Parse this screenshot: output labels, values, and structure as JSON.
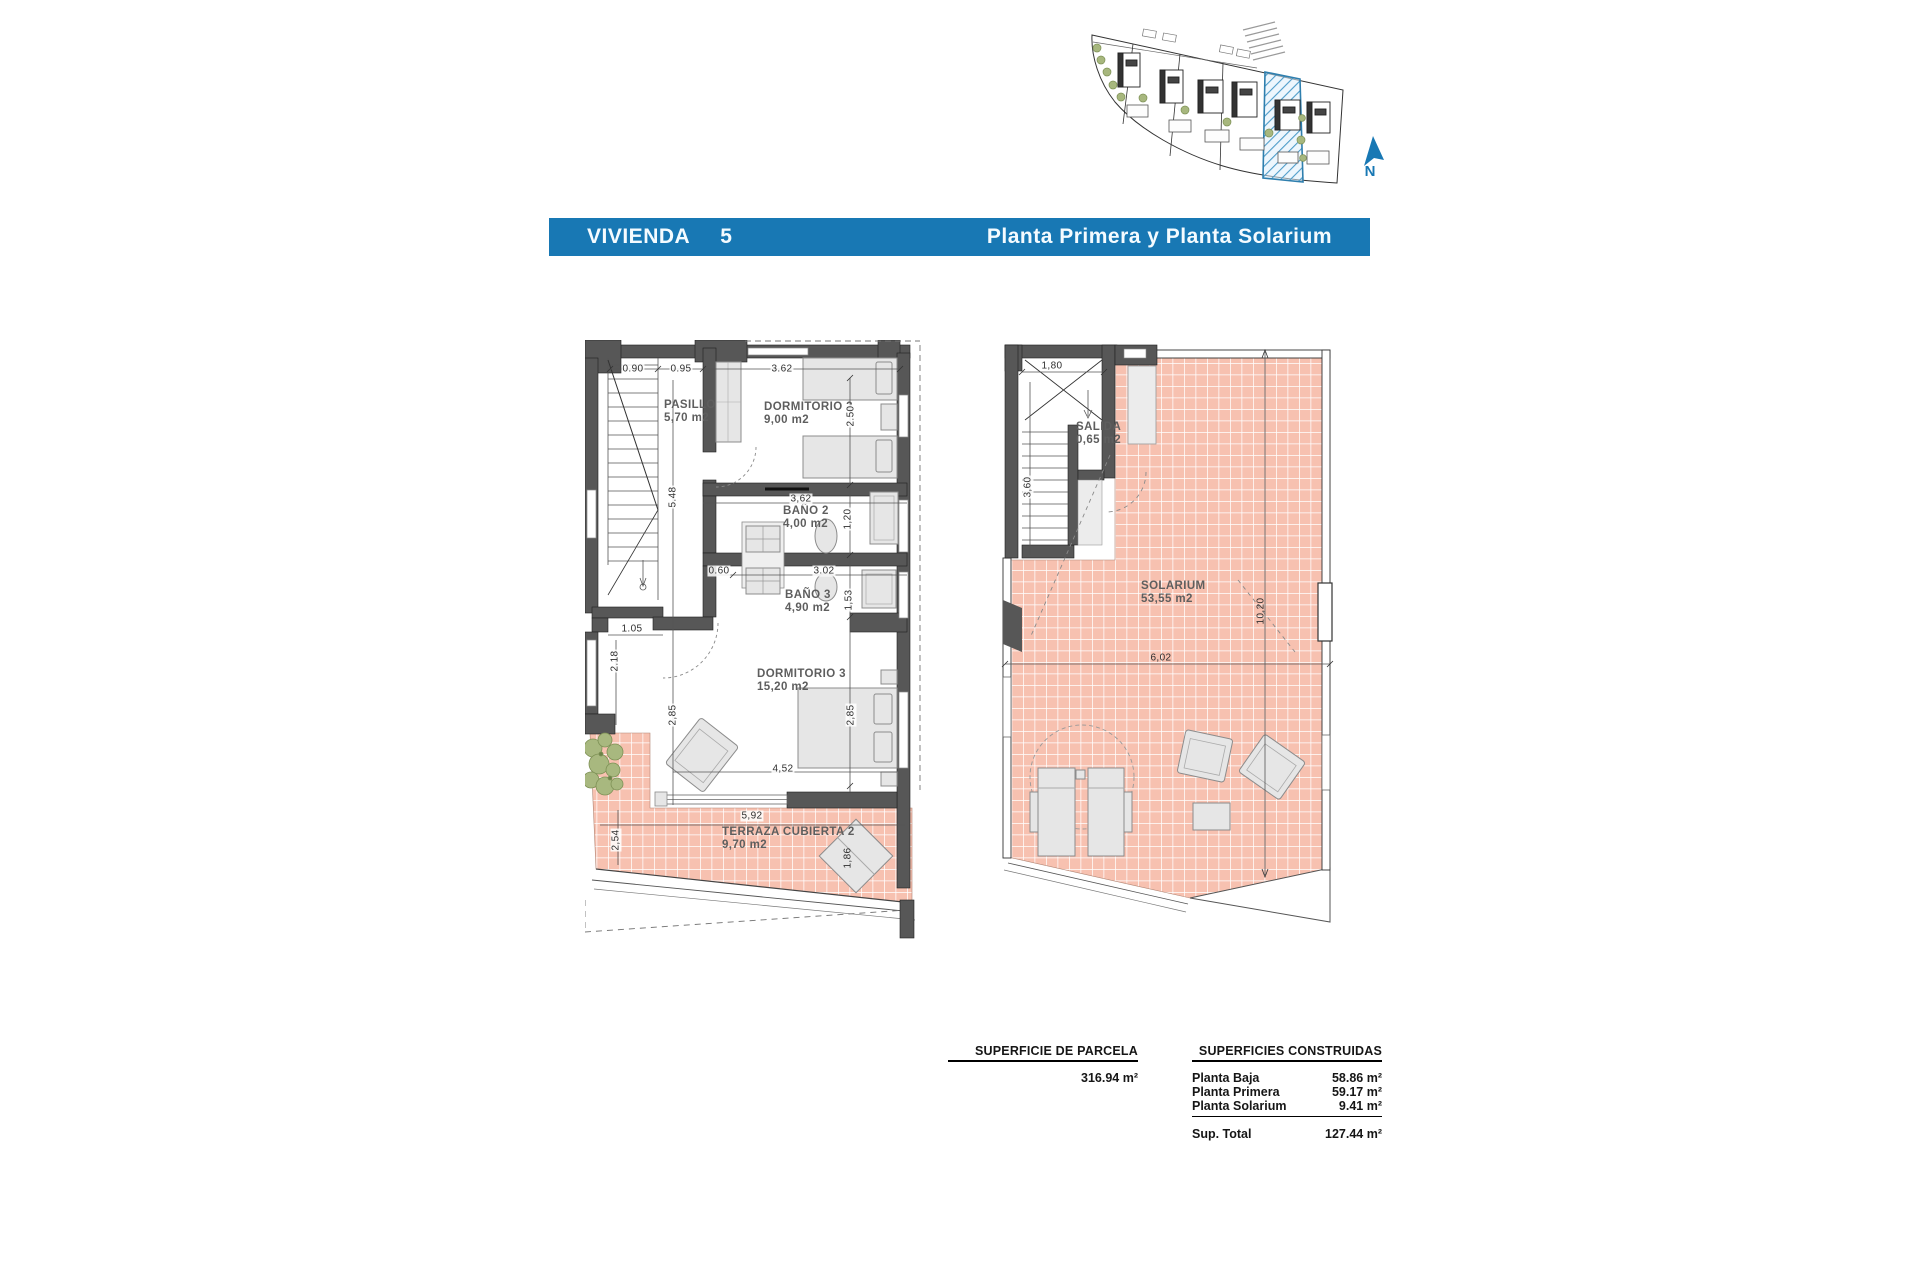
{
  "header": {
    "label": "VIVIENDA",
    "number": "5",
    "subtitle": "Planta Primera y Planta Solarium",
    "bar_color": "#1878b4"
  },
  "site_plan": {
    "north": "N",
    "highlight_color": "#2f7fae"
  },
  "first_floor": {
    "rooms": {
      "pasillo": {
        "name": "PASILLO",
        "area": "5,70 m2"
      },
      "dorm2": {
        "name": "DORMITORIO 2",
        "area": "9,00 m2"
      },
      "bano2": {
        "name": "BAÑO 2",
        "area": "4,00 m2"
      },
      "bano3": {
        "name": "BAÑO 3",
        "area": "4,90 m2"
      },
      "dorm3": {
        "name": "DORMITORIO 3",
        "area": "15,20 m2"
      },
      "terraza": {
        "name": "TERRAZA CUBIERTA 2",
        "area": "9,70 m2"
      }
    },
    "dims": {
      "a": "0.90",
      "b": "0.95",
      "c": "3.62",
      "d": "2.50",
      "e": "5.48",
      "f": "3,62",
      "g": "1,20",
      "h": "0.60",
      "i": "3.02",
      "j": "1,53",
      "k": "1.05",
      "l": "2.18",
      "m": "2,85",
      "n": "2,85",
      "o": "4,52",
      "p": "5,92",
      "q": "2,54",
      "r": "1,86"
    }
  },
  "solarium": {
    "rooms": {
      "salida": {
        "name": "SALIDA",
        "area": "0,65 m2"
      },
      "solarium": {
        "name": "SOLARIUM",
        "area": "53,55 m2"
      }
    },
    "dims": {
      "a": "1,80",
      "b": "3,60",
      "c": "10,20",
      "d": "6,02"
    }
  },
  "summary": {
    "parcel_heading": "SUPERFICIE DE PARCELA",
    "parcel_value": "316.94 m²",
    "built_heading": "SUPERFICIES CONSTRUIDAS",
    "built_rows": [
      {
        "label": "Planta Baja",
        "value": "58.86 m²"
      },
      {
        "label": "Planta Primera",
        "value": "59.17 m²"
      },
      {
        "label": "Planta Solarium",
        "value": "9.41 m²"
      }
    ],
    "total_label": "Sup. Total",
    "total_value": "127.44 m²"
  }
}
